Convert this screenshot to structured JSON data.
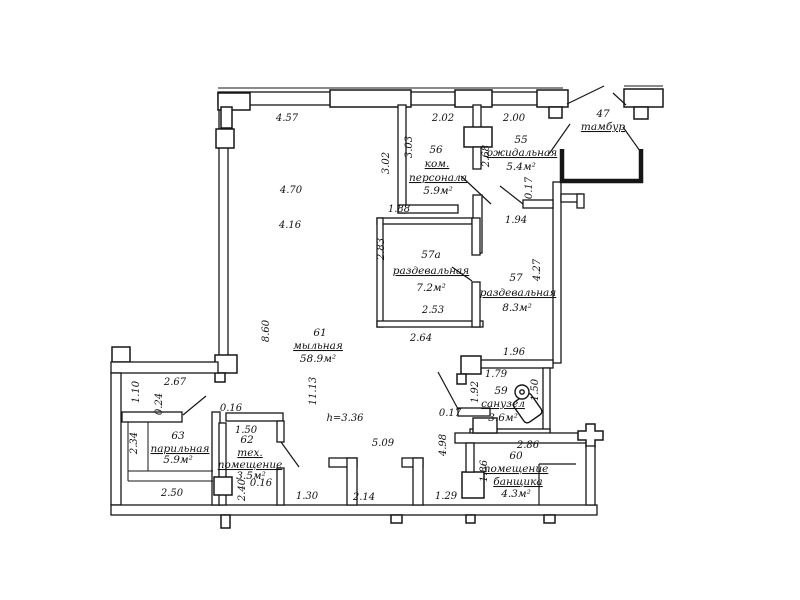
{
  "drawing": {
    "kind": "floor-plan",
    "line_color": "#161616",
    "background": "#ffffff"
  },
  "rooms": {
    "r47": {
      "num": "47",
      "name": "тамбур"
    },
    "r55": {
      "num": "55",
      "name": "ожидальная",
      "area": "5.4м²"
    },
    "r56": {
      "num": "56",
      "name1": "ком.",
      "name2": "персонала",
      "area": "5.9м²"
    },
    "r57a": {
      "num": "57а",
      "name": "раздевальная",
      "area": "7.2м²"
    },
    "r57": {
      "num": "57",
      "name": "раздевальная",
      "area": "8.3м²"
    },
    "r59": {
      "num": "59",
      "name": "санузел",
      "area": "3.6м²"
    },
    "r60": {
      "num": "60",
      "name1": "помещение",
      "name2": "банщика",
      "area": "4.3м²"
    },
    "r61": {
      "num": "61",
      "name": "мыльная",
      "area": "58.9м²"
    },
    "r62": {
      "num": "62",
      "name1": "тех.",
      "name2": "помещение",
      "area": "3.5м²"
    },
    "r63": {
      "num": "63",
      "name": "парильная",
      "area": "5.9м²"
    }
  },
  "dims": {
    "top1": "4.57",
    "top2": "2.02",
    "top3": "2.00",
    "w61a": "4.70",
    "w61b": "4.16",
    "v56out": "3.02",
    "v56in": "3.03",
    "b56": "1.88",
    "v55": "2.68",
    "stub55": "0.17",
    "b55": "1.94",
    "v57a": "2.83",
    "w57a": "2.53",
    "b57a": "2.64",
    "v57": "4.27",
    "b57": "1.96",
    "v61a": "8.60",
    "v61b": "11.13",
    "w61c": "5.09",
    "v61c": "4.98",
    "stub59": "0.17",
    "t59": "1.79",
    "v59": "1.92",
    "v59r": "1.50",
    "t60": "2.86",
    "v60": "1.86",
    "cb1": "1.30",
    "cb2": "2.14",
    "cb3": "1.29",
    "sec1": "2.67",
    "sec2": "1.10",
    "sec3": "0.24",
    "v63": "2.34",
    "b63": "2.50",
    "t62": "1.50",
    "s62a": "0.16",
    "s62b": "0.16",
    "v62": "2.40",
    "h": "h=3.36"
  }
}
